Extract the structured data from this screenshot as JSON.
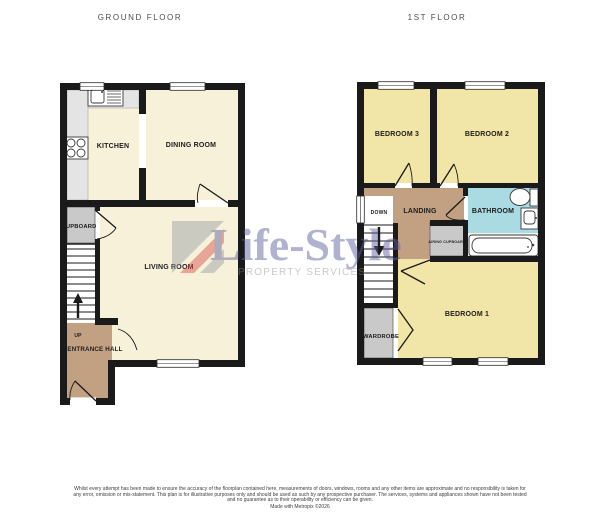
{
  "titles": {
    "ground": "GROUND FLOOR",
    "first": "1ST FLOOR"
  },
  "ground_floor": {
    "rooms": {
      "kitchen": "KITCHEN",
      "dining": "DINING ROOM",
      "living": "LIVING ROOM",
      "cupboard": "CUPBOARD",
      "entrance": "ENTRANCE HALL",
      "up": "UP"
    }
  },
  "first_floor": {
    "rooms": {
      "bedroom3": "BEDROOM 3",
      "bedroom2": "BEDROOM 2",
      "bedroom1": "BEDROOM 1",
      "landing": "LANDING",
      "bathroom": "BATHROOM",
      "airing": "AIRING CUPBOARD",
      "wardrobe": "WARDROBE",
      "down": "DOWN"
    }
  },
  "watermark": {
    "brand": "Life-Style",
    "tagline": "PROPERTY SERVICES"
  },
  "footer": {
    "disclaimer": "Whilst every attempt has been made to ensure the accuracy of the floorplan contained here, measurements of doors, windows, rooms and any other items are approximate and no responsibility is taken for any error, omission or mis-statement. This plan is for illustrative purposes only and should be used as such by any prospective purchaser. The services, systems and appliances shown have not been tested and no guarantee as to their operability or efficiency can be given.",
    "credit": "Made with Metropix ©2026"
  },
  "colors": {
    "wall": "#1a1a1a",
    "cream": "#f7f1da",
    "yellow": "#f1e5a7",
    "brown": "#c2a182",
    "blue": "#aadbe3",
    "gray": "#c9c9c9",
    "counter": "#e4e4e4",
    "wm_purple": "#5b5f9e",
    "wm_red": "#d9534f",
    "wm_gray": "#9aa0a6"
  }
}
